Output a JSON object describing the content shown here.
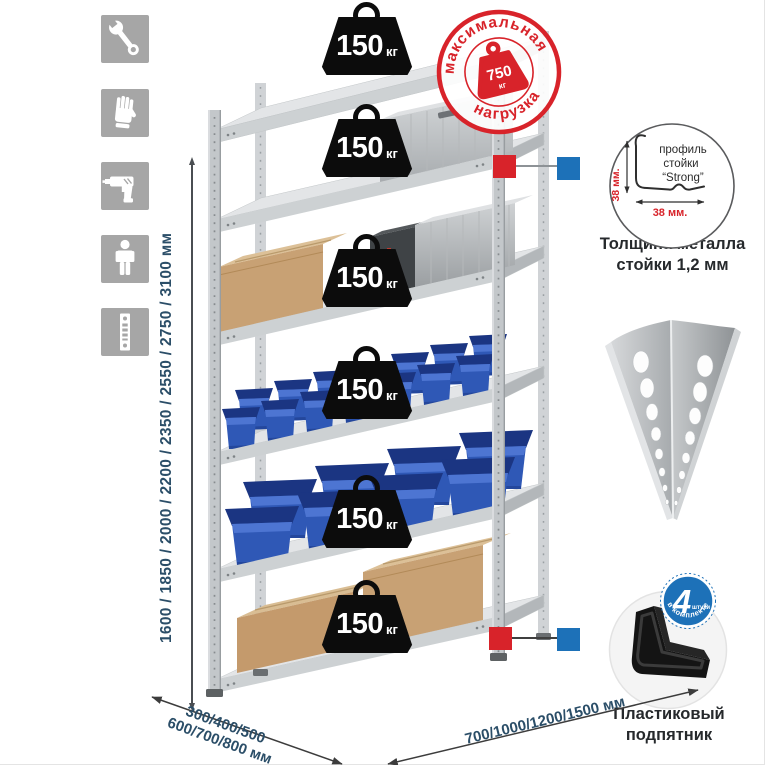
{
  "sidebar_icons": [
    {
      "name": "wrench-icon"
    },
    {
      "name": "gloves-icon"
    },
    {
      "name": "drill-icon"
    },
    {
      "name": "person-icon"
    },
    {
      "name": "rack-post-icon"
    }
  ],
  "dimensions": {
    "height": "1600 / 1850 / 2000 / 2200 / 2350 / 2550 / 2750 / 3100 мм",
    "depth_line1": "300/400/500",
    "depth_line2": "600/700/800 мм",
    "width": "700/1000/1200/1500 мм"
  },
  "shelf_badges": {
    "count": 6,
    "value": "150",
    "unit": "кг"
  },
  "max_load_stamp": {
    "arc_top": "максимальная",
    "arc_bottom": "нагрузка",
    "value": "750",
    "unit": "кг"
  },
  "profile_detail": {
    "label_line1": "профиль",
    "label_line2": "стойки",
    "label_line3": "“Strong”",
    "dim_vertical": "38 мм.",
    "dim_horizontal": "38 мм.",
    "caption_line1": "Толщина металла",
    "caption_line2": "стойки 1,2 мм"
  },
  "foot_detail": {
    "badge_value": "4",
    "badge_unit": "штуки",
    "badge_arc": "в комплекте",
    "caption_line1": "Пластиковый",
    "caption_line2": "подпятник"
  },
  "colors": {
    "accent_red": "#d8232a",
    "accent_blue": "#1d71b8",
    "bin_blue": "#2f58b6",
    "text_navy": "#2b4e68",
    "badge_black": "#0c0c0c"
  }
}
